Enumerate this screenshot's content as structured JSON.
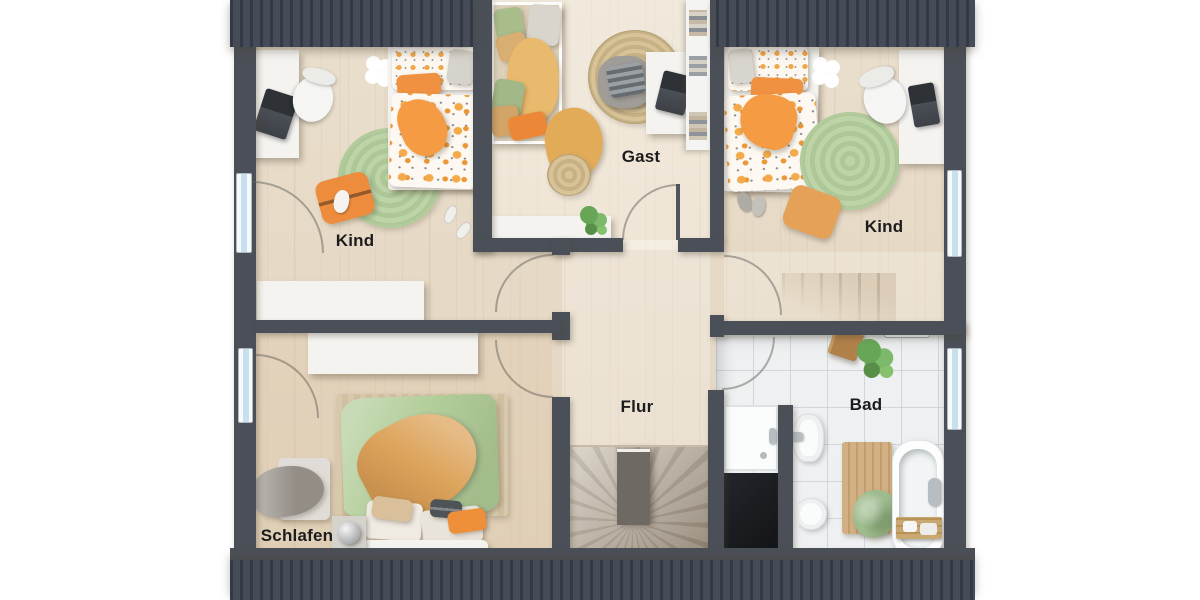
{
  "rooms": {
    "kind_left": "Kind",
    "gast": "Gast",
    "kind_right": "Kind",
    "flur": "Flur",
    "schlafen": "Schlafen",
    "bad": "Bad"
  },
  "colors": {
    "wall": "#4b5058",
    "roof_dark": "#343b46",
    "roof_light": "#454c58",
    "floor_wood": "#e7dbc8",
    "floor_tile": "#eef0f1",
    "rug_green": "#b7cf9f",
    "rug_jute": "#d2bd93",
    "accent_orange": "#ee8f3d",
    "accent_yellow": "#e6b167",
    "duvet_green": "#b5cf9d",
    "window_glass": "#c8dff0",
    "label_text": "#1c1c1e"
  }
}
